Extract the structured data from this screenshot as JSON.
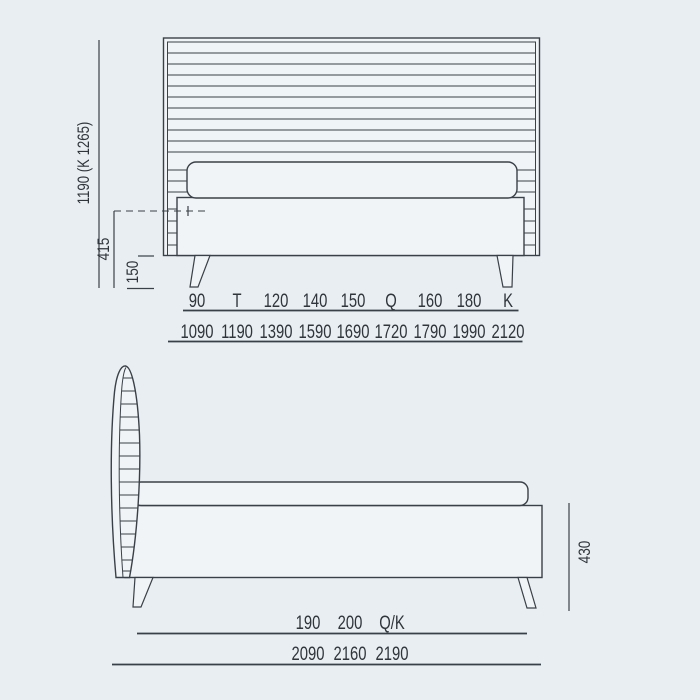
{
  "drawing": {
    "title": "bed-technical-drawing",
    "colors": {
      "background": "#e8eef2",
      "line": "#3a4047",
      "fill": "#f0f4f7",
      "text": "#2f353b"
    },
    "front_view": {
      "total_height_label": "1190 (K 1265)",
      "frame_height_label": "415",
      "leg_height_label": "150",
      "size_row": [
        "90",
        "T",
        "120",
        "140",
        "150",
        "Q",
        "160",
        "180",
        "K"
      ],
      "width_row": [
        "1090",
        "1190",
        "1390",
        "1590",
        "1690",
        "1720",
        "1790",
        "1990",
        "2120"
      ]
    },
    "side_view": {
      "base_height_label": "430",
      "size_row": [
        "190",
        "200",
        "Q/K"
      ],
      "length_row": [
        "2090",
        "2160",
        "2190"
      ]
    }
  }
}
